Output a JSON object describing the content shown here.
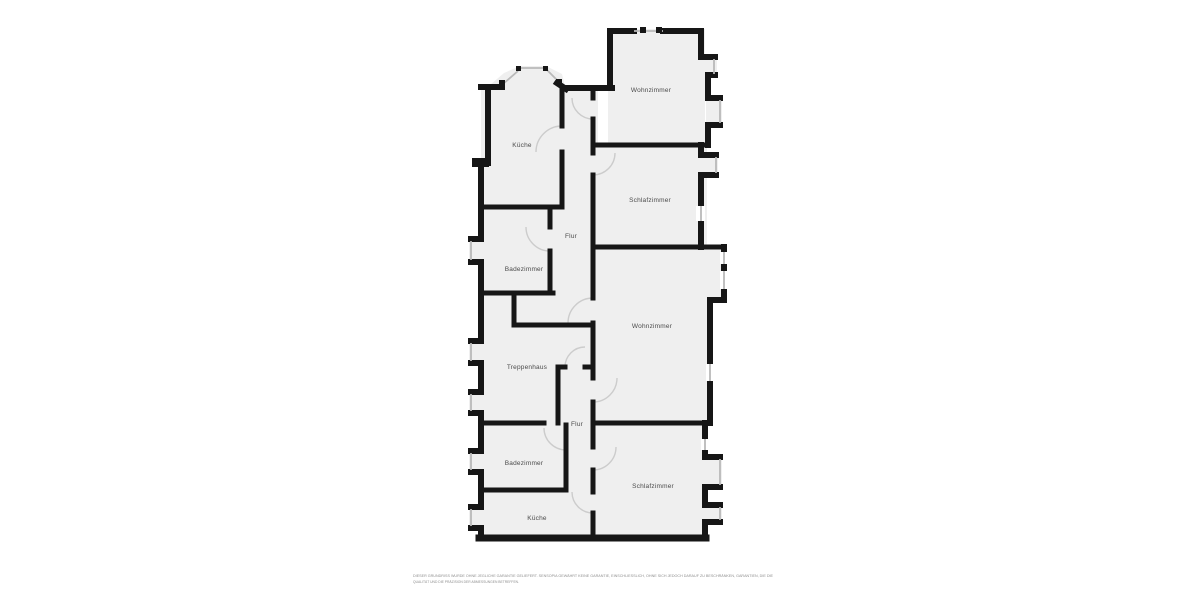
{
  "plan": {
    "colors": {
      "background": "#ffffff",
      "floor": "#efefef",
      "wall": "#161616",
      "window": "#b9b9b9",
      "door": "#cccccc",
      "label": "#4a4a4a",
      "disclaimer": "#8f8f8f"
    },
    "rooms": [
      {
        "id": "wohnzimmer-top",
        "label": "Wohnzimmer"
      },
      {
        "id": "kueche-top",
        "label": "Küche"
      },
      {
        "id": "schlafzimmer-top",
        "label": "Schlafzimmer"
      },
      {
        "id": "flur-top",
        "label": "Flur"
      },
      {
        "id": "badezimmer-top",
        "label": "Badezimmer"
      },
      {
        "id": "wohnzimmer-middle",
        "label": "Wohnzimmer"
      },
      {
        "id": "treppenhaus",
        "label": "Treppenhaus"
      },
      {
        "id": "flur-bottom",
        "label": "Flur"
      },
      {
        "id": "badezimmer-bottom",
        "label": "Badezimmer"
      },
      {
        "id": "schlafzimmer-bottom",
        "label": "Schlafzimmer"
      },
      {
        "id": "kueche-bottom",
        "label": "Küche"
      }
    ],
    "disclaimer": {
      "line1": "DIESER GRUNDRISS WURDE OHNE JEGLICHE GARANTIE GELIEFERT. SENSOPIA GEWÄHRT KEINE GARANTIE, EINSCHLIESSLICH, OHNE SICH JEDOCH DARAUF ZU BESCHRÄNKEN, GARANTIEN, DIE DIE",
      "line2": "QUALITÄT UND DIE PRÄZISION DER ABMESSUNGEN BETREFFEN."
    }
  }
}
